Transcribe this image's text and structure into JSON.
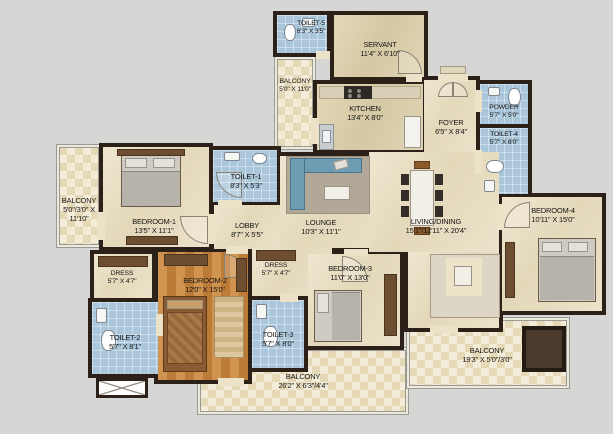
{
  "plan": {
    "colors": {
      "wall": "#2b2119",
      "marble_floor": "#eae0c6",
      "tan_floor": "#ddd1b2",
      "bath_tile": "#a9c6db",
      "wood_floor": "#c8853f",
      "balcony_tile": "#f0e8d2",
      "background": "#d6d6d4",
      "sofa_blue": "#6d9cb3"
    },
    "rooms": {
      "toilet5": {
        "name": "TOILET-5",
        "dims": "6'3\" X 3'5\""
      },
      "servant": {
        "name": "SERVANT",
        "dims": "11'4\" X 6'10\""
      },
      "balcony_top": {
        "name": "BALCONY",
        "dims": "5'0\" X 11'0\""
      },
      "kitchen": {
        "name": "KITCHEN",
        "dims": "13'4\" X 8'0\""
      },
      "foyer": {
        "name": "FOYER",
        "dims": "6'5\" X 8'4\""
      },
      "powder": {
        "name": "POWDER",
        "dims": "5'7\" X 5'0\""
      },
      "toilet4": {
        "name": "TOILET-4",
        "dims": "5'7\" X 8'0\""
      },
      "balcony_left": {
        "name": "BALCONY",
        "dims": "5'0\"/3'0\" X",
        "dims2": "11'10\""
      },
      "bedroom1": {
        "name": "BEDROOM-1",
        "dims": "13'5\" X 11'1\""
      },
      "toilet1": {
        "name": "TOILET-1",
        "dims": "8'3\" X 5'3\""
      },
      "lobby": {
        "name": "LOBBY",
        "dims": "8'7\" X 5'5\""
      },
      "lounge": {
        "name": "LOUNGE",
        "dims": "10'3\" X 11'1\""
      },
      "living": {
        "name": "LIVING/DINING",
        "dims": "15'1\"/12'11\" X 20'4\""
      },
      "bedroom4": {
        "name": "BEDROOM-4",
        "dims": "10'11\" X 15'0\""
      },
      "dress1": {
        "name": "DRESS",
        "dims": "5'7\" X 4'7\""
      },
      "bedroom2": {
        "name": "BEDROOM-2",
        "dims": "12'0\" X 15'0\""
      },
      "dress2": {
        "name": "DRESS",
        "dims": "5'7\" X 4'7\""
      },
      "bedroom3": {
        "name": "BEDROOM-3",
        "dims": "11'0\" X 13'0\""
      },
      "toilet2": {
        "name": "TOILET-2",
        "dims": "5'7\" X 8'1\""
      },
      "toilet3": {
        "name": "TOILET-3",
        "dims": "5'7\" X 8'0\""
      },
      "balcony_bottom": {
        "name": "BALCONY",
        "dims": "26'2\" X 6'3\"/4'4\""
      },
      "balcony_right": {
        "name": "BALCONY",
        "dims": "19'3\" X 5'0\"/3'0\""
      }
    }
  }
}
